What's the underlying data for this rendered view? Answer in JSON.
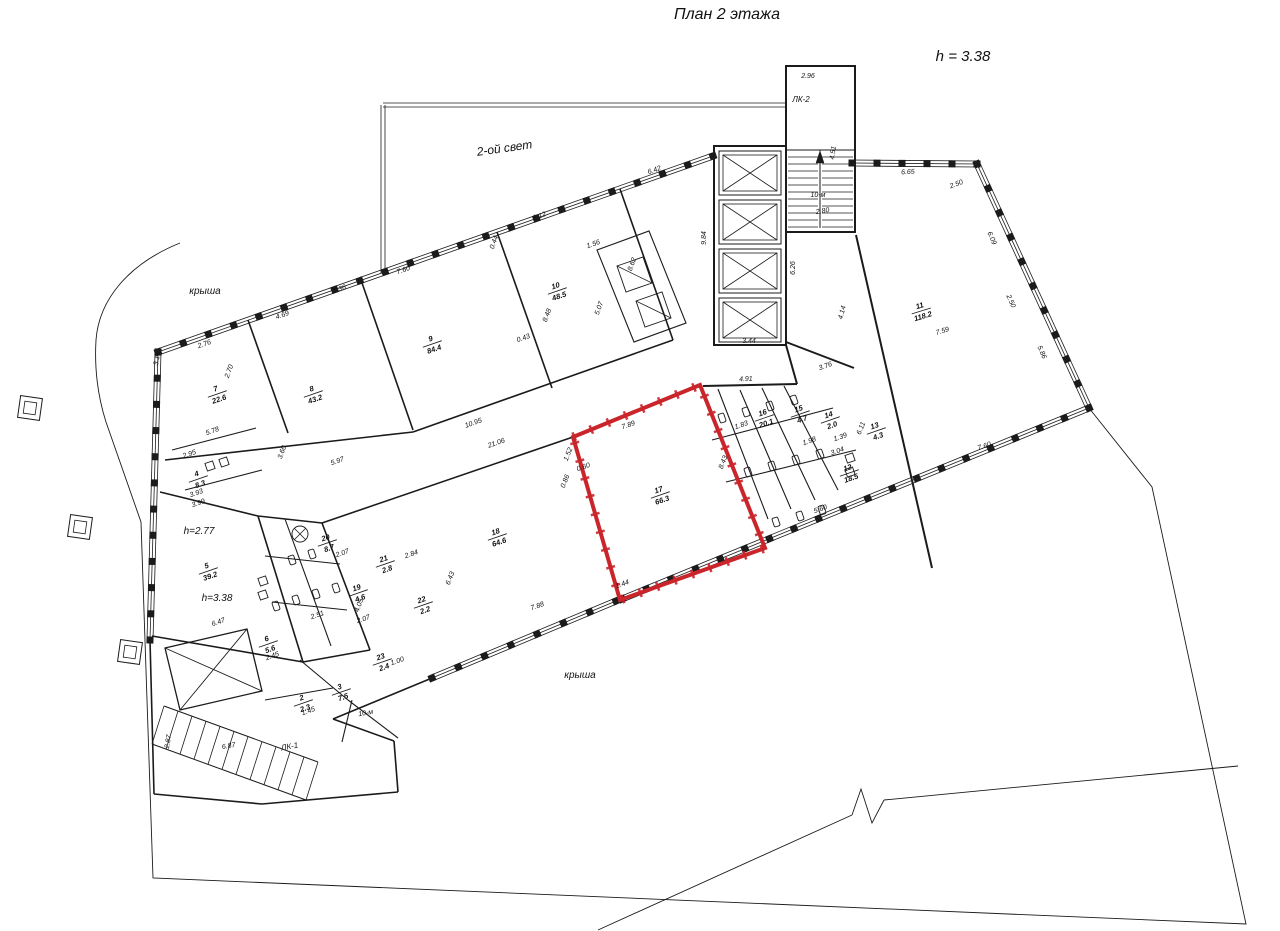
{
  "title": "План 2 этажа",
  "height_note": "h = 3.38",
  "colors": {
    "line": "#1b1b1b",
    "highlight": "#c9252b"
  },
  "labels": [
    {
      "text": "2-ой свет",
      "x": 505,
      "y": 152,
      "r": -8,
      "fs": 12
    },
    {
      "text": "крыша",
      "x": 205,
      "y": 294,
      "r": 0,
      "fs": 10
    },
    {
      "text": "крыша",
      "x": 580,
      "y": 678,
      "r": 0,
      "fs": 10
    },
    {
      "text": "ЛК-2",
      "x": 801,
      "y": 102,
      "r": 0,
      "fs": 8
    },
    {
      "text": "ЛК-1",
      "x": 290,
      "y": 749,
      "r": -10,
      "fs": 8
    },
    {
      "text": "h=2.77",
      "x": 199,
      "y": 534,
      "r": 0,
      "fs": 10
    },
    {
      "text": "h=3.38",
      "x": 217,
      "y": 601,
      "r": 0,
      "fs": 10
    },
    {
      "text": "10-м",
      "x": 818,
      "y": 197,
      "r": 0,
      "fs": 7
    },
    {
      "text": "10-м",
      "x": 366,
      "y": 715,
      "r": -10,
      "fs": 7
    }
  ],
  "rooms": [
    {
      "n": "2",
      "a": "2.3",
      "x": 303,
      "y": 702,
      "r": -19
    },
    {
      "n": "3",
      "a": "7.5",
      "x": 341,
      "y": 691,
      "r": -19
    },
    {
      "n": "4",
      "a": "8.3",
      "x": 198,
      "y": 478,
      "r": -19
    },
    {
      "n": "5",
      "a": "39.2",
      "x": 208,
      "y": 570,
      "r": -19
    },
    {
      "n": "6",
      "a": "5.6",
      "x": 268,
      "y": 643,
      "r": -19
    },
    {
      "n": "7",
      "a": "22.6",
      "x": 217,
      "y": 393,
      "r": -19
    },
    {
      "n": "8",
      "a": "43.2",
      "x": 313,
      "y": 393,
      "r": -19
    },
    {
      "n": "9",
      "a": "84.4",
      "x": 432,
      "y": 343,
      "r": -19
    },
    {
      "n": "10",
      "a": "48.5",
      "x": 557,
      "y": 290,
      "r": -19
    },
    {
      "n": "11",
      "a": "118.2",
      "x": 921,
      "y": 310,
      "r": -17
    },
    {
      "n": "12",
      "a": "18.5",
      "x": 849,
      "y": 472,
      "r": -19
    },
    {
      "n": "13",
      "a": "4.3",
      "x": 876,
      "y": 430,
      "r": -19
    },
    {
      "n": "14",
      "a": "2.0",
      "x": 830,
      "y": 419,
      "r": -19
    },
    {
      "n": "15",
      "a": "4.7",
      "x": 800,
      "y": 413,
      "r": -19
    },
    {
      "n": "16",
      "a": "20.1",
      "x": 764,
      "y": 417,
      "r": -19
    },
    {
      "n": "17",
      "a": "66.3",
      "x": 660,
      "y": 494,
      "r": -19
    },
    {
      "n": "18",
      "a": "64.6",
      "x": 497,
      "y": 536,
      "r": -19
    },
    {
      "n": "19",
      "a": "4.6",
      "x": 358,
      "y": 592,
      "r": -19
    },
    {
      "n": "20",
      "a": "8.7",
      "x": 327,
      "y": 542,
      "r": -19
    },
    {
      "n": "21",
      "a": "2.8",
      "x": 385,
      "y": 563,
      "r": -19
    },
    {
      "n": "22",
      "a": "2.2",
      "x": 423,
      "y": 604,
      "r": -19
    },
    {
      "n": "23",
      "a": "2.4",
      "x": 382,
      "y": 661,
      "r": -19
    }
  ],
  "dims": [
    {
      "t": "2.96",
      "x": 808,
      "y": 78,
      "r": 0
    },
    {
      "t": "4.51",
      "x": 835,
      "y": 153,
      "r": -83
    },
    {
      "t": "2.80",
      "x": 823,
      "y": 213,
      "r": -10
    },
    {
      "t": "9.84",
      "x": 706,
      "y": 238,
      "r": -90
    },
    {
      "t": "6.26",
      "x": 795,
      "y": 268,
      "r": -90
    },
    {
      "t": "3.44",
      "x": 749,
      "y": 343,
      "r": 0
    },
    {
      "t": "4.14",
      "x": 844,
      "y": 313,
      "r": -75
    },
    {
      "t": "3.76",
      "x": 826,
      "y": 368,
      "r": -19
    },
    {
      "t": "6.42",
      "x": 655,
      "y": 172,
      "r": -19
    },
    {
      "t": "6.65",
      "x": 908,
      "y": 174,
      "r": -3
    },
    {
      "t": "2.50",
      "x": 957,
      "y": 186,
      "r": -20
    },
    {
      "t": "6.09",
      "x": 990,
      "y": 239,
      "r": 66
    },
    {
      "t": "2.50",
      "x": 1009,
      "y": 302,
      "r": 66
    },
    {
      "t": "5.86",
      "x": 1040,
      "y": 353,
      "r": 66
    },
    {
      "t": "7.59",
      "x": 943,
      "y": 333,
      "r": -17
    },
    {
      "t": "7.60",
      "x": 985,
      "y": 448,
      "r": -19
    },
    {
      "t": "2.76",
      "x": 205,
      "y": 346,
      "r": -19
    },
    {
      "t": "4.69",
      "x": 283,
      "y": 317,
      "r": -19
    },
    {
      "t": "1.36",
      "x": 340,
      "y": 291,
      "r": -19
    },
    {
      "t": "7.60",
      "x": 404,
      "y": 272,
      "r": -19
    },
    {
      "t": "0.44",
      "x": 496,
      "y": 243,
      "r": -70
    },
    {
      "t": "6.12",
      "x": 540,
      "y": 218,
      "r": -19
    },
    {
      "t": "1.56",
      "x": 594,
      "y": 246,
      "r": -19
    },
    {
      "t": "8.62",
      "x": 634,
      "y": 265,
      "r": -70
    },
    {
      "t": "5.07",
      "x": 601,
      "y": 309,
      "r": -70
    },
    {
      "t": "8.48",
      "x": 549,
      "y": 316,
      "r": -70
    },
    {
      "t": "0.43",
      "x": 524,
      "y": 340,
      "r": -19
    },
    {
      "t": "3.16",
      "x": 159,
      "y": 359,
      "r": -80
    },
    {
      "t": "2.70",
      "x": 231,
      "y": 372,
      "r": -70
    },
    {
      "t": "5.78",
      "x": 213,
      "y": 433,
      "r": -19
    },
    {
      "t": "2.95",
      "x": 190,
      "y": 456,
      "r": -19
    },
    {
      "t": "3.93",
      "x": 197,
      "y": 495,
      "r": -19
    },
    {
      "t": "3.99",
      "x": 199,
      "y": 505,
      "r": -19
    },
    {
      "t": "3.60",
      "x": 284,
      "y": 453,
      "r": -70
    },
    {
      "t": "5.97",
      "x": 338,
      "y": 463,
      "r": -19
    },
    {
      "t": "10.95",
      "x": 474,
      "y": 425,
      "r": -19
    },
    {
      "t": "21.06",
      "x": 497,
      "y": 445,
      "r": -19
    },
    {
      "t": "6.47",
      "x": 219,
      "y": 624,
      "r": -19
    },
    {
      "t": "2.45",
      "x": 273,
      "y": 658,
      "r": -19
    },
    {
      "t": "2.51",
      "x": 318,
      "y": 617,
      "r": -19
    },
    {
      "t": "2.07",
      "x": 343,
      "y": 555,
      "r": -19
    },
    {
      "t": "2.07",
      "x": 364,
      "y": 621,
      "r": -19
    },
    {
      "t": "4.05",
      "x": 361,
      "y": 606,
      "r": -70
    },
    {
      "t": "2.84",
      "x": 412,
      "y": 556,
      "r": -19
    },
    {
      "t": "1.00",
      "x": 398,
      "y": 663,
      "r": -19
    },
    {
      "t": "1.45",
      "x": 309,
      "y": 713,
      "r": -19
    },
    {
      "t": "2.87",
      "x": 170,
      "y": 742,
      "r": -80
    },
    {
      "t": "6.87",
      "x": 229,
      "y": 748,
      "r": -10
    },
    {
      "t": "7.89",
      "x": 629,
      "y": 427,
      "r": -19
    },
    {
      "t": "8.43",
      "x": 725,
      "y": 463,
      "r": -68
    },
    {
      "t": "1.52",
      "x": 570,
      "y": 455,
      "r": -68
    },
    {
      "t": "0.60",
      "x": 584,
      "y": 469,
      "r": -19
    },
    {
      "t": "0.86",
      "x": 567,
      "y": 482,
      "r": -68
    },
    {
      "t": "1.44",
      "x": 623,
      "y": 586,
      "r": -19
    },
    {
      "t": "6.43",
      "x": 452,
      "y": 579,
      "r": -68
    },
    {
      "t": "7.88",
      "x": 538,
      "y": 608,
      "r": -19
    },
    {
      "t": "4.91",
      "x": 746,
      "y": 381,
      "r": -3
    },
    {
      "t": "1.83",
      "x": 742,
      "y": 427,
      "r": -19
    },
    {
      "t": "1.98",
      "x": 810,
      "y": 443,
      "r": -19
    },
    {
      "t": "1.39",
      "x": 841,
      "y": 439,
      "r": -19
    },
    {
      "t": "3.04",
      "x": 838,
      "y": 453,
      "r": -19
    },
    {
      "t": "5.60",
      "x": 821,
      "y": 511,
      "r": -19
    },
    {
      "t": "6.11",
      "x": 863,
      "y": 429,
      "r": -68
    }
  ]
}
